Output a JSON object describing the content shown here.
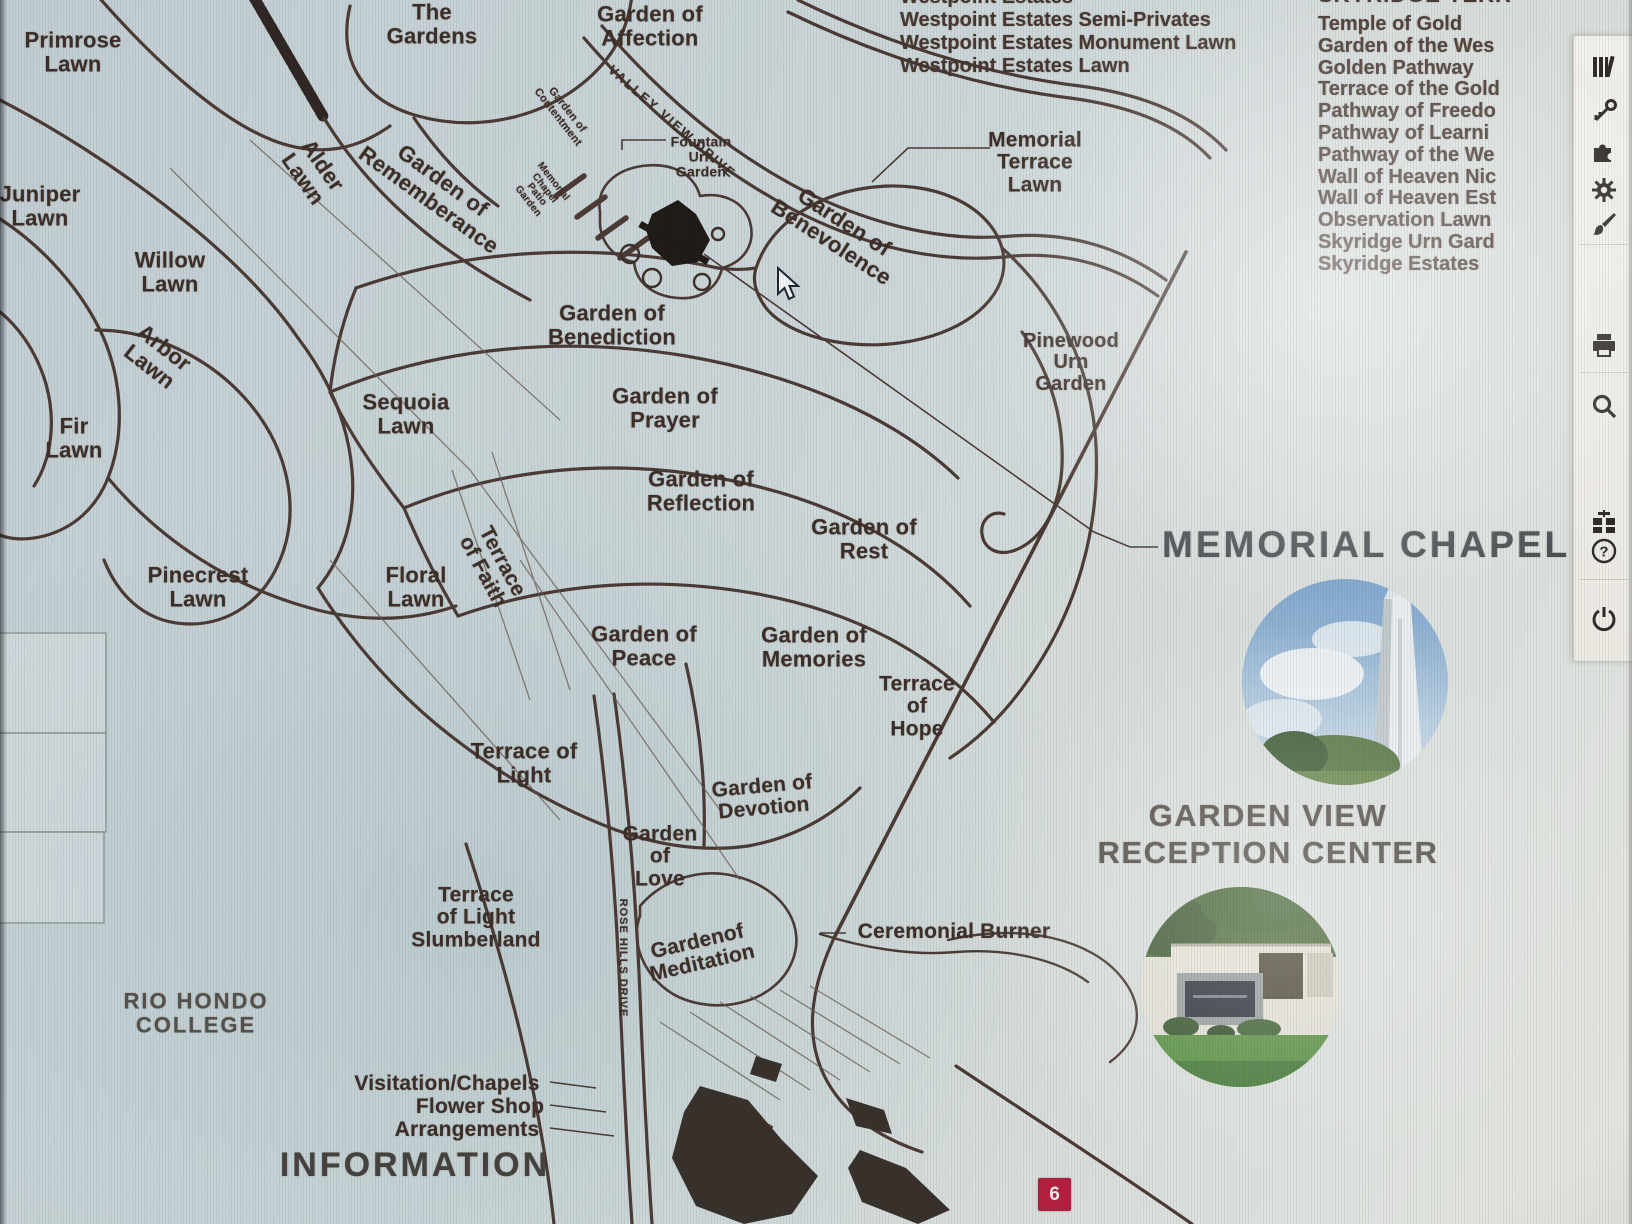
{
  "colors": {
    "background": "#c7d2d6",
    "map_ink": "#4a3a33",
    "label_text": "#3c2e27",
    "badge_red": "#b41f3f",
    "chapel_heading_gray": "#4c4f52",
    "garden_view_brown": "#57504a",
    "toolbar_bg": "#f1efe9",
    "icon_dark": "#2e2b28"
  },
  "map": {
    "labels": [
      {
        "t": "Primrose\nLawn",
        "x": 73,
        "y": 52,
        "s": 22
      },
      {
        "t": "Juniper\nLawn",
        "x": 40,
        "y": 206,
        "s": 22
      },
      {
        "t": "Willow\nLawn",
        "x": 170,
        "y": 272,
        "s": 22
      },
      {
        "t": "Arbor\nLawn",
        "x": 157,
        "y": 357,
        "s": 22,
        "r": 38
      },
      {
        "t": "Fir\nLawn",
        "x": 74,
        "y": 438,
        "s": 22
      },
      {
        "t": "Alder\nLawn",
        "x": 313,
        "y": 172,
        "s": 22,
        "r": 55
      },
      {
        "t": "The\nGardens",
        "x": 432,
        "y": 24,
        "s": 22
      },
      {
        "t": "Garden of\nAffection",
        "x": 650,
        "y": 26,
        "s": 22
      },
      {
        "t": "Garden of\nRememberance",
        "x": 436,
        "y": 190,
        "s": 22,
        "r": 36
      },
      {
        "t": "Garden of\nContentment",
        "x": 562,
        "y": 114,
        "s": 11,
        "r": 52
      },
      {
        "t": "Memorial\nChapel\nPatio\nGarden",
        "x": 540,
        "y": 192,
        "s": 10,
        "r": 52
      },
      {
        "t": "VALLEY VIEW DRIVE",
        "x": 672,
        "y": 122,
        "s": 13,
        "r": 41,
        "ls": 2,
        "w": 700
      },
      {
        "t": "Fountain\nUrn\nGarden",
        "x": 701,
        "y": 157,
        "s": 14,
        "w": 700
      },
      {
        "t": "Garden of\nBenevolence",
        "x": 838,
        "y": 232,
        "s": 22,
        "r": 33
      },
      {
        "t": "Memorial\nTerrace\nLawn",
        "x": 1035,
        "y": 163,
        "s": 21
      },
      {
        "t": "Garden of\nBenediction",
        "x": 612,
        "y": 325,
        "s": 22
      },
      {
        "t": "Sequoia\nLawn",
        "x": 406,
        "y": 414,
        "s": 22
      },
      {
        "t": "Garden of\nPrayer",
        "x": 665,
        "y": 408,
        "s": 22
      },
      {
        "t": "Garden of\nReflection",
        "x": 701,
        "y": 491,
        "s": 22
      },
      {
        "t": "Garden of\nRest",
        "x": 864,
        "y": 539,
        "s": 22
      },
      {
        "t": "Pinewood\nUrn\nGarden",
        "x": 1071,
        "y": 363,
        "s": 20
      },
      {
        "t": "Pinecrest\nLawn",
        "x": 198,
        "y": 587,
        "s": 22
      },
      {
        "t": "Floral\nLawn",
        "x": 416,
        "y": 587,
        "s": 22
      },
      {
        "t": "Terrace\nof Faith",
        "x": 492,
        "y": 567,
        "s": 21,
        "r": 62
      },
      {
        "t": "Garden of\nPeace",
        "x": 644,
        "y": 646,
        "s": 22
      },
      {
        "t": "Garden of\nMemories",
        "x": 814,
        "y": 647,
        "s": 22
      },
      {
        "t": "Terrace\nof\nHope",
        "x": 917,
        "y": 707,
        "s": 21
      },
      {
        "t": "Terrace of\nLight",
        "x": 524,
        "y": 763,
        "s": 22
      },
      {
        "t": "Garden of\nDevotion",
        "x": 763,
        "y": 798,
        "s": 21,
        "r": -5
      },
      {
        "t": "Garden\nof\nLove",
        "x": 660,
        "y": 857,
        "s": 21
      },
      {
        "t": "Terrace\nof Light\nSlumberland",
        "x": 476,
        "y": 918,
        "s": 21
      },
      {
        "t": "Gardenof\nMeditation",
        "x": 700,
        "y": 953,
        "s": 21,
        "r": -13
      },
      {
        "t": "ROSE HILLS DRIVE",
        "x": 622,
        "y": 958,
        "s": 11,
        "r": 90,
        "ls": 1
      },
      {
        "t": "RIO HONDO\nCOLLEGE",
        "x": 196,
        "y": 1013,
        "s": 22,
        "ls": 2,
        "c": "#55514a"
      },
      {
        "t": "Ceremonial Burner",
        "x": 954,
        "y": 932,
        "s": 21
      },
      {
        "t": "Visitation/Chapels",
        "x": 447,
        "y": 1084,
        "s": 21
      },
      {
        "t": "Flower Shop",
        "x": 480,
        "y": 1107,
        "s": 21
      },
      {
        "t": "Arrangements",
        "x": 467,
        "y": 1130,
        "s": 21
      },
      {
        "t": "INFORMATION",
        "x": 415,
        "y": 1165,
        "s": 34,
        "ls": 3,
        "w": 600,
        "c": "#45413d"
      },
      {
        "t": "Parking",
        "x": 753,
        "y": 1118,
        "s": 12,
        "r": 30
      }
    ]
  },
  "lists": {
    "westpoint": [
      "Westpoint Estates",
      "Westpoint Estates Semi-Privates",
      "Westpoint Estates Monument Lawn",
      "Westpoint Estates Lawn"
    ],
    "skyridge_heading": "SKYRIDGE TERR",
    "skyridge": [
      "Temple of Gold",
      "Garden of the Wes",
      "Golden Pathway",
      "Terrace of the Gold",
      "Pathway of Freedo",
      "Pathway of Learni",
      "Pathway of the We",
      "Wall of Heaven Nic",
      "Wall of Heaven Est",
      "Observation Lawn",
      "Skyridge Urn Gard",
      "Skyridge Estates"
    ]
  },
  "callouts": {
    "memorial_chapel": "MEMORIAL CHAPEL",
    "garden_view_line1": "GARDEN VIEW",
    "garden_view_line2": "RECEPTION CENTER"
  },
  "badge": {
    "number": "6"
  },
  "toolbar": {
    "icons": [
      "library-icon",
      "key-icon",
      "puzzle-icon",
      "settings-icon",
      "paintbrush-icon",
      "printer-icon",
      "search-icon",
      "gift-icon",
      "help-icon",
      "power-icon"
    ]
  }
}
